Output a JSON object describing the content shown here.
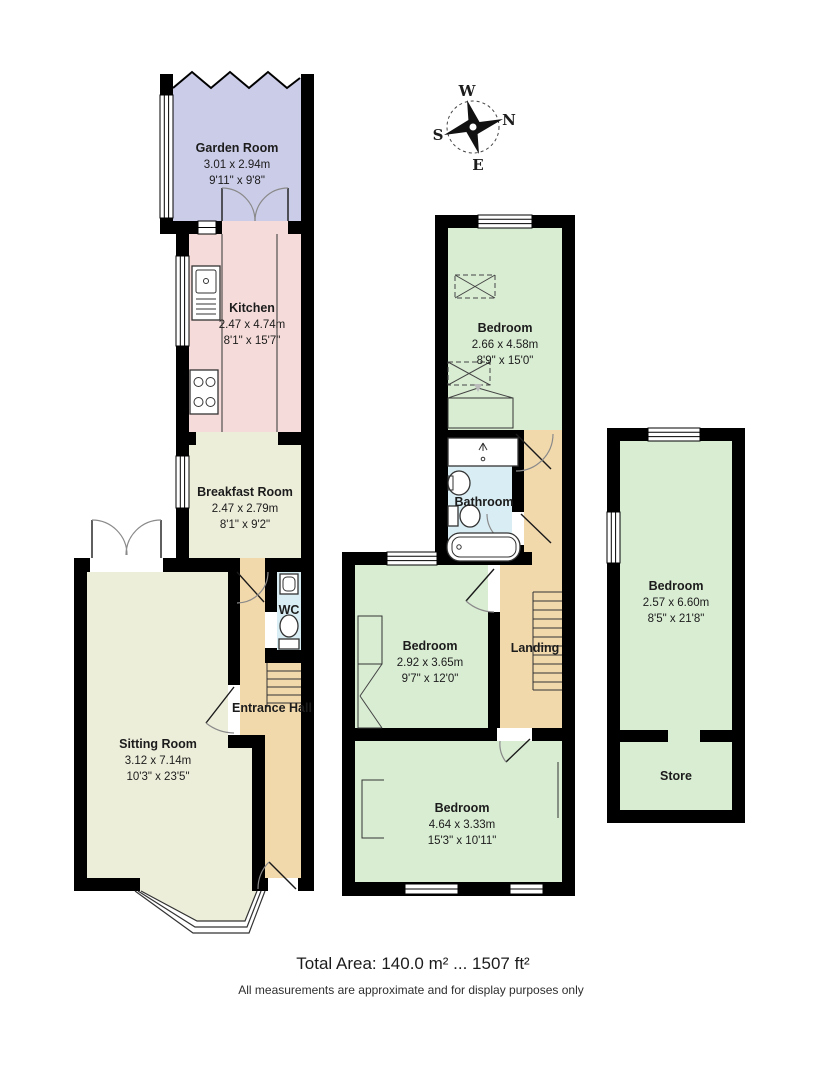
{
  "colors": {
    "wall": "#000000",
    "garden": "#cbcce8",
    "kitchen": "#f5dcda",
    "cream": "#edeeda",
    "tan": "#f2d9ac",
    "blue": "#d9eef4",
    "green": "#d9edd3",
    "paper": "#ffffff"
  },
  "compass": {
    "west": "W",
    "north": "N",
    "south": "S",
    "east": "E"
  },
  "rooms": {
    "garden_room": {
      "name": "Garden Room",
      "metric": "3.01 x 2.94m",
      "imperial": "9'11\" x 9'8\""
    },
    "kitchen": {
      "name": "Kitchen",
      "metric": "2.47 x 4.74m",
      "imperial": "8'1\" x 15'7\""
    },
    "breakfast_room": {
      "name": "Breakfast Room",
      "metric": "2.47 x 2.79m",
      "imperial": "8'1\" x 9'2\""
    },
    "wc": {
      "name": "WC"
    },
    "entrance_hall": {
      "name": "Entrance Hall"
    },
    "sitting_room": {
      "name": "Sitting Room",
      "metric": "3.12 x 7.14m",
      "imperial": "10'3\" x 23'5\""
    },
    "bedroom_1": {
      "name": "Bedroom",
      "metric": "2.66 x 4.58m",
      "imperial": "8'9\" x 15'0\""
    },
    "bathroom": {
      "name": "Bathroom"
    },
    "bedroom_2": {
      "name": "Bedroom",
      "metric": "2.92 x 3.65m",
      "imperial": "9'7\" x 12'0\""
    },
    "landing": {
      "name": "Landing"
    },
    "bedroom_3": {
      "name": "Bedroom",
      "metric": "4.64 x 3.33m",
      "imperial": "15'3\" x 10'11\""
    },
    "bedroom_4": {
      "name": "Bedroom",
      "metric": "2.57 x 6.60m",
      "imperial": "8'5\" x 21'8\""
    },
    "store": {
      "name": "Store"
    }
  },
  "footer": {
    "total_area": "Total Area: 140.0 m² ... 1507 ft²",
    "disclaimer": "All measurements are approximate and for display purposes only"
  }
}
